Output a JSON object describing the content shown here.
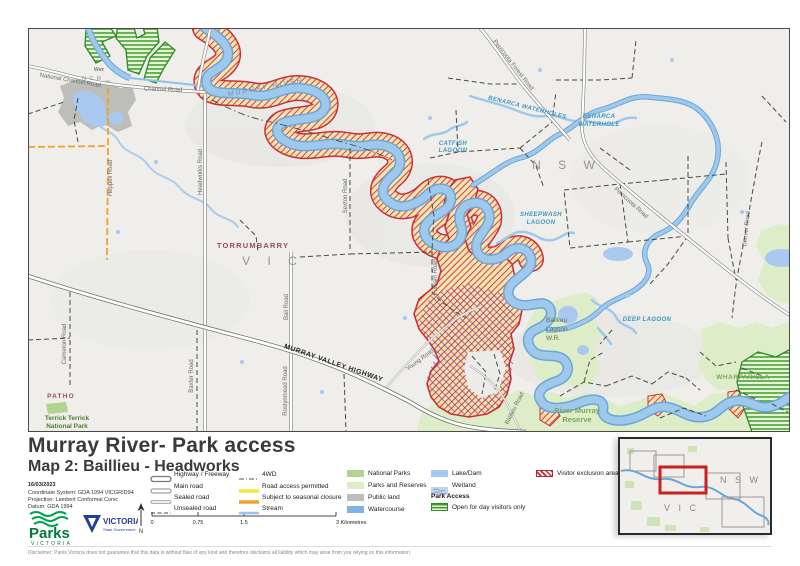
{
  "title": "Murray River- Park access",
  "subtitle": "Map 2: Baillieu - Headworks",
  "date": "16/03/2023",
  "meta": {
    "coordinate_system": "Coordinate System: GDA 1994 VICGRID94",
    "projection": "Projection: Lambert Conformal Conic",
    "datum": "Datum: GDA 1994"
  },
  "disclaimer": "Disclaimer: Parks Victoria does not guarantee that this data is without flaw of any kind and therefore disclaims all liability which may arise from you relying on this information.",
  "logos": {
    "parks": "Parks",
    "parks_sub": "VICTORIA",
    "vicgov": "VICTORIA",
    "vicgov_sub": "State Government"
  },
  "scalebar": {
    "tick0": "0",
    "tick1": "0.75",
    "tick2": "1.5",
    "tick3": "3 Kilometres"
  },
  "colors": {
    "exclusion_red": "#c9303c",
    "seasonal_orange": "#f0a22e",
    "permitted_yellow": "#f7e93c",
    "watercourse_blue": "#7fb2e5",
    "lake_blue": "#a9c9f0",
    "national_park_green": "#b2d48e",
    "reserve_green": "#dcedc8",
    "public_land_grey": "#bdbdb9",
    "open_day_green": "#3e9c33"
  },
  "legend": {
    "road_items": [
      {
        "label": "Highway / Freeway"
      },
      {
        "label": "Main road"
      },
      {
        "label": "Sealed road"
      },
      {
        "label": "Unsealed road"
      }
    ],
    "access_items": [
      {
        "label": "4WD"
      },
      {
        "label": "Road access permitted"
      },
      {
        "label": "Subject to seasonal closure"
      },
      {
        "label": "Stream"
      }
    ],
    "area_items": [
      {
        "label": "National Parks"
      },
      {
        "label": "Parks and Reserves"
      },
      {
        "label": "Public land"
      },
      {
        "label": "Watercourse"
      }
    ],
    "water_items": [
      {
        "label": "Lake/Dam"
      },
      {
        "label": "Wetland"
      }
    ],
    "park_access_header": "Park Access",
    "open_day_label": "Open for day visitors only",
    "exclusion_label": "Visitor exclusion area"
  },
  "inset": {
    "nsw": "N S W",
    "vic": "V I C"
  },
  "map": {
    "labels": {
      "murray_river": "MURRAY RIVER",
      "ncr": "N C R",
      "weir": "Weir",
      "national_channel_road": "National Channel Road",
      "channel_road": "Channel Road",
      "headworks_road": "Headworks Road",
      "heppell_road": "Heppell Road",
      "sexton_road": "Sexton Road",
      "fulham_road": "Fulham Road",
      "cameron_road": "Cameron Road",
      "baxter_road": "Baxter Road",
      "roslynmead_road": "Roslynmead Road",
      "bail_road": "Bail Road",
      "young_road": "Young Road",
      "baillieu_road": "Baillieu Road",
      "denver_road": "Denver Road",
      "perricoota_road": "Perricoota Road",
      "perricoota_forest_road": "Perricoota Forest Road",
      "murray_valley_highway": "MURRAY VALLEY HIGHWAY",
      "torrumbarry": "TORRUMBARRY",
      "patho": "PATHO",
      "nsw": "N S W",
      "vic": "V I C",
      "catfish_1": "CATFISH",
      "catfish_2": "LAGOON",
      "sheepwash_1": "SHEEPWASH",
      "sheepwash_2": "LAGOON",
      "benarca_1": "BENARCA",
      "benarca_2": "WATERHOLE",
      "benarca_stream": "BENARCA WATERHOLES",
      "deep_lagoon": "DEEP LAGOON",
      "baillieu_wr_1": "Baillieu",
      "baillieu_wr_2": "Lagoon",
      "baillieu_wr_3": "W.R.",
      "river_murray_1": "River Murray",
      "river_murray_2": "Reserve",
      "wharparilla": "WHARPARILLA",
      "terrick_1": "Terrick Terrick",
      "terrick_2": "National Park"
    }
  }
}
